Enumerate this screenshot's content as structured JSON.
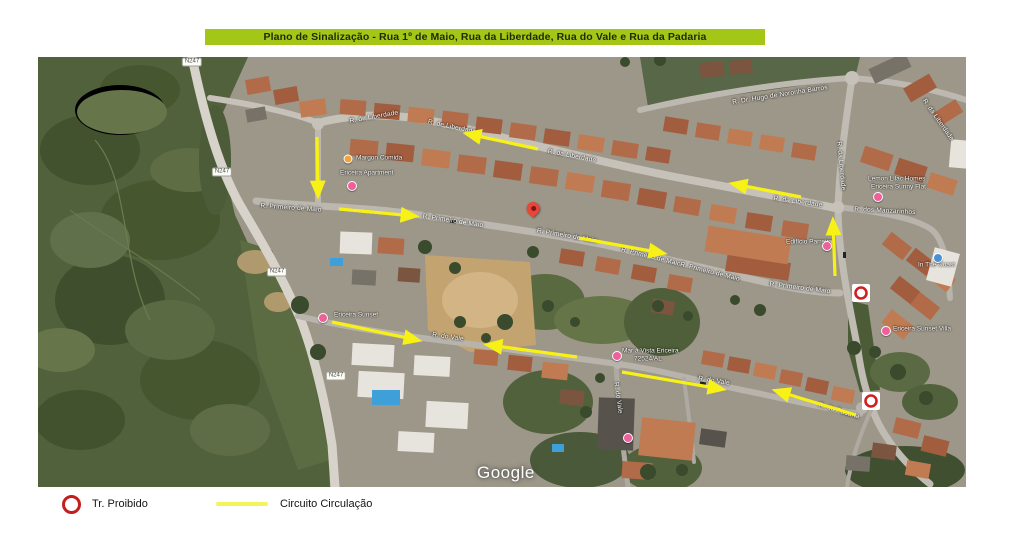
{
  "title": {
    "text": "Plano de Sinalização - Rua 1º de Maio, Rua da Liberdade, Rua do Vale e Rua da Padaria",
    "banner_color": "#a4c717"
  },
  "legend": {
    "prohibited_label": "Tr. Proibido",
    "circuit_label": "Circuito Circulação",
    "ring_color": "#c41d1d",
    "line_color": "#f4f45a"
  },
  "map": {
    "attribution": "Google",
    "arrow_color": "#f7f115",
    "route_refs": [
      {
        "text": "N247",
        "x": 192,
        "y": 62
      },
      {
        "text": "N247",
        "x": 222,
        "y": 172
      },
      {
        "text": "N247",
        "x": 277,
        "y": 272
      },
      {
        "text": "N247",
        "x": 336,
        "y": 376
      }
    ],
    "road_labels": [
      {
        "text": "R. de Liberdade",
        "x": 374,
        "y": 117,
        "rot": -10
      },
      {
        "text": "R. de Liberdade",
        "x": 452,
        "y": 127,
        "rot": 12
      },
      {
        "text": "R. da Liberdade",
        "x": 572,
        "y": 156,
        "rot": 11
      },
      {
        "text": "R. da Liberdade",
        "x": 798,
        "y": 202,
        "rot": 8
      },
      {
        "text": "R. da Liberdade",
        "x": 841,
        "y": 166,
        "rot": 85
      },
      {
        "text": "R. da Liberdade",
        "x": 938,
        "y": 120,
        "rot": 55
      },
      {
        "text": "R. Primeiro de Maio",
        "x": 291,
        "y": 208,
        "rot": 4
      },
      {
        "text": "R. Primeiro de Maio",
        "x": 453,
        "y": 221,
        "rot": 9
      },
      {
        "text": "R. Primeiro de Maio",
        "x": 567,
        "y": 236,
        "rot": 10
      },
      {
        "text": "R. Primeiro de Maio",
        "x": 651,
        "y": 257,
        "rot": 14
      },
      {
        "text": "R. Primeiro de Maio",
        "x": 710,
        "y": 272,
        "rot": 14
      },
      {
        "text": "R. Primeiro de Maio",
        "x": 800,
        "y": 288,
        "rot": 7
      },
      {
        "text": "R. Dr. Hugo de Noronha Barros",
        "x": 780,
        "y": 95,
        "rot": -9
      },
      {
        "text": "R. dos Manzarinhos",
        "x": 885,
        "y": 211,
        "rot": 3
      },
      {
        "text": "R. da Padaria",
        "x": 839,
        "y": 411,
        "rot": 17
      },
      {
        "text": "R. do Vale",
        "x": 448,
        "y": 337,
        "rot": 8
      },
      {
        "text": "R. do Vale",
        "x": 714,
        "y": 381,
        "rot": 9
      },
      {
        "text": "R. do Vale",
        "x": 618,
        "y": 398,
        "rot": 82
      }
    ],
    "poi_labels": [
      {
        "text": "Margon Comida",
        "x": 356,
        "y": 158
      },
      {
        "text": "Ericeira Apartment",
        "x": 340,
        "y": 173
      },
      {
        "text": "Lemon Lilac Homes",
        "x": 868,
        "y": 179
      },
      {
        "text": "Ericeira Sunny Flat",
        "x": 871,
        "y": 187
      },
      {
        "text": "Edifício Parreira",
        "x": 786,
        "y": 242
      },
      {
        "text": "In The Coast",
        "x": 918,
        "y": 265
      },
      {
        "text": "Ericeira Sunset Villa",
        "x": 893,
        "y": 329
      },
      {
        "text": "Ericeira Sunset",
        "x": 334,
        "y": 315
      },
      {
        "text": "Mar à Vista Ericeira",
        "x": 622,
        "y": 351
      },
      {
        "text": "72524/AL",
        "x": 634,
        "y": 359
      }
    ],
    "markers": [
      {
        "type": "orange-dot",
        "x": 348,
        "y": 159
      },
      {
        "type": "pink-pin",
        "x": 352,
        "y": 186
      },
      {
        "type": "red-pin",
        "x": 533,
        "y": 215
      },
      {
        "type": "pink-pin",
        "x": 617,
        "y": 356
      },
      {
        "type": "pink-pin",
        "x": 628,
        "y": 438
      },
      {
        "type": "pink-pin",
        "x": 827,
        "y": 246
      },
      {
        "type": "pink-pin",
        "x": 878,
        "y": 197
      },
      {
        "type": "blue-pin",
        "x": 938,
        "y": 258
      },
      {
        "type": "pink-pin",
        "x": 886,
        "y": 331
      },
      {
        "type": "pink-pin",
        "x": 323,
        "y": 318
      }
    ],
    "circulation_arrows": [
      {
        "x1": 317,
        "y1": 137,
        "x2": 318,
        "y2": 194
      },
      {
        "x1": 538,
        "y1": 149,
        "x2": 468,
        "y2": 134
      },
      {
        "x1": 801,
        "y1": 197,
        "x2": 734,
        "y2": 184
      },
      {
        "x1": 339,
        "y1": 209,
        "x2": 414,
        "y2": 216
      },
      {
        "x1": 579,
        "y1": 238,
        "x2": 662,
        "y2": 253
      },
      {
        "x1": 835,
        "y1": 276,
        "x2": 833,
        "y2": 222
      },
      {
        "x1": 332,
        "y1": 322,
        "x2": 417,
        "y2": 340
      },
      {
        "x1": 577,
        "y1": 357,
        "x2": 489,
        "y2": 345
      },
      {
        "x1": 622,
        "y1": 372,
        "x2": 721,
        "y2": 389
      },
      {
        "x1": 856,
        "y1": 415,
        "x2": 777,
        "y2": 391
      }
    ],
    "no_entry_signs": [
      {
        "x": 861,
        "y": 293
      },
      {
        "x": 871,
        "y": 401
      }
    ]
  }
}
